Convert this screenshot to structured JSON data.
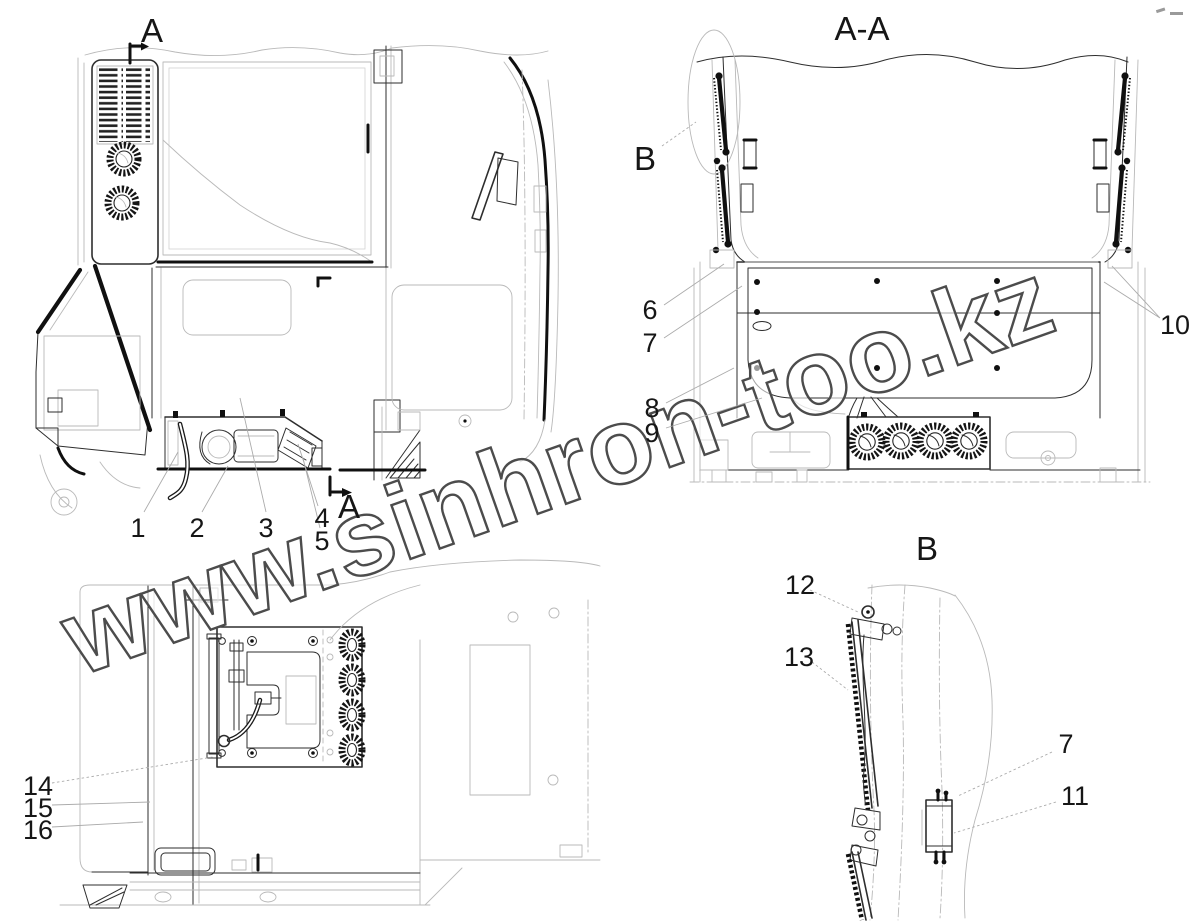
{
  "watermark": {
    "text": "www.sinhron-too.kz",
    "outline_color": "#4c4c4c"
  },
  "colors": {
    "main_line": "#2e2e2e",
    "thick_line": "#101010",
    "light_line": "#b9b9b9",
    "label": "#161616",
    "background": "#ffffff"
  },
  "views": {
    "side_view": {
      "section_label_top": "A",
      "section_label_bottom": "A",
      "callouts": {
        "c1": "1",
        "c2": "2",
        "c3": "3",
        "c4": "4",
        "c5": "5"
      }
    },
    "section_view_aa": {
      "title": "A-A",
      "detail_marker": "B",
      "callouts": {
        "c6": "6",
        "c7": "7",
        "c8": "8",
        "c9": "9",
        "c10": "10"
      }
    },
    "rear_view": {
      "callouts": {
        "c14": "14",
        "c15": "15",
        "c16": "16"
      }
    },
    "detail_view_b": {
      "title": "B",
      "callouts": {
        "c12": "12",
        "c13": "13",
        "c7": "7",
        "c11": "11"
      }
    }
  }
}
